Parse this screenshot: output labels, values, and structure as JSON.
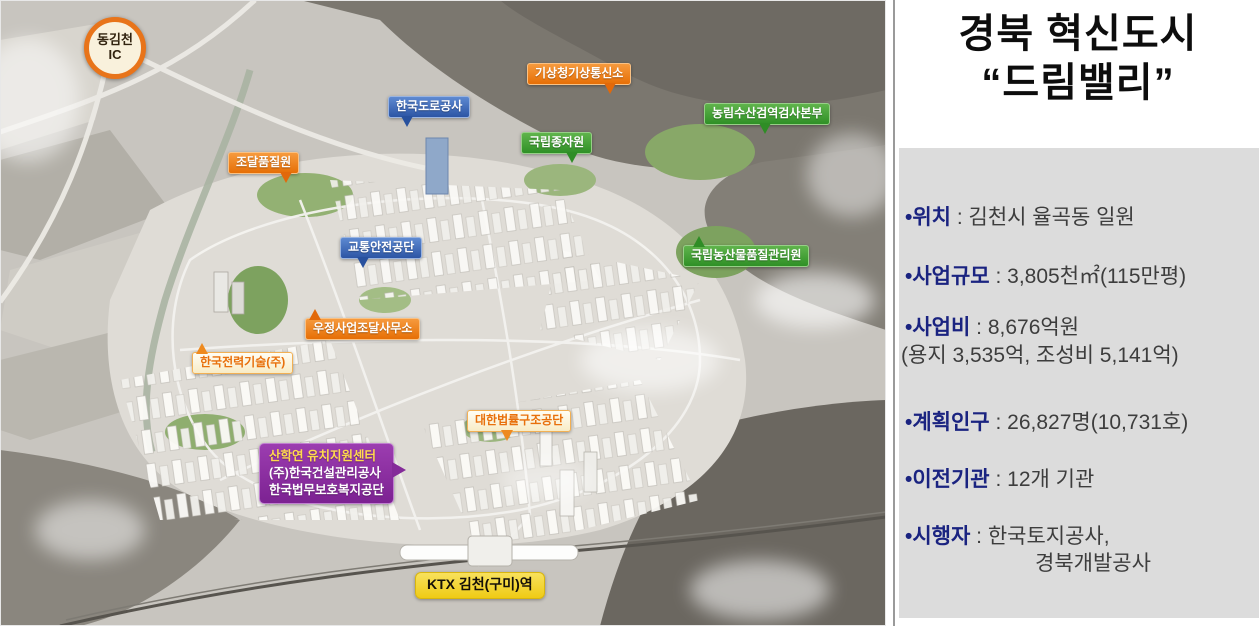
{
  "map": {
    "ic_badge": {
      "line1": "동김천",
      "line2": "IC"
    },
    "labels": [
      {
        "id": "weather-comm-station",
        "text": "기상청기상통신소"
      },
      {
        "id": "korea-expressway-corp",
        "text": "한국도로공사"
      },
      {
        "id": "agri-quarantine-hq",
        "text": "농림수산검역검사본부"
      },
      {
        "id": "national-seed-agency",
        "text": "국립종자원"
      },
      {
        "id": "procurement-quality-inst",
        "text": "조달품질원"
      },
      {
        "id": "traffic-safety-authority",
        "text": "교통안전공단"
      },
      {
        "id": "agri-products-quality-service",
        "text": "국립농산물품질관리원"
      },
      {
        "id": "postal-procurement-office",
        "text": "우정사업조달사무소"
      },
      {
        "id": "kepco-engineering",
        "text": "한국전력기술(주)"
      },
      {
        "id": "legal-aid-corp",
        "text": "대한법률구조공단"
      },
      {
        "id": "ktx-station",
        "text": "KTX 김천(구미)역"
      }
    ],
    "multi_label": {
      "line1": "산학연 유치지원센터",
      "line2": "(주)한국건설관리공사",
      "line3": "한국법무보호복지공단"
    }
  },
  "panel": {
    "title_line1": "경북 혁신도시",
    "title_line2": "“드림밸리”",
    "separator": " : ",
    "items": [
      {
        "label": "•위치",
        "value": "김천시 율곡동 일원"
      },
      {
        "label": "•사업규모",
        "value": "3,805천㎡(115만평)"
      },
      {
        "label": "•사업비",
        "value": "8,676억원",
        "value2": "(용지 3,535억, 조성비 5,141억)"
      },
      {
        "label": "•계획인구",
        "value": "26,827명(10,731호)"
      },
      {
        "label": "•이전기관",
        "value": "12개 기관"
      },
      {
        "label": "•시행자",
        "value": "한국토지공사,",
        "value2": "경북개발공사"
      }
    ]
  },
  "colors": {
    "label_orange": "#ed7d18",
    "label_blue": "#3a68b4",
    "label_green": "#46a335",
    "label_purple": "#8e2fa2",
    "label_yellow": "#f3d12c",
    "cream_box_text": "#e8740e",
    "panel_label_navy": "#1a2380",
    "panel_value_gray": "#3d3d3d",
    "info_box_bg": "#dcdcdc"
  }
}
